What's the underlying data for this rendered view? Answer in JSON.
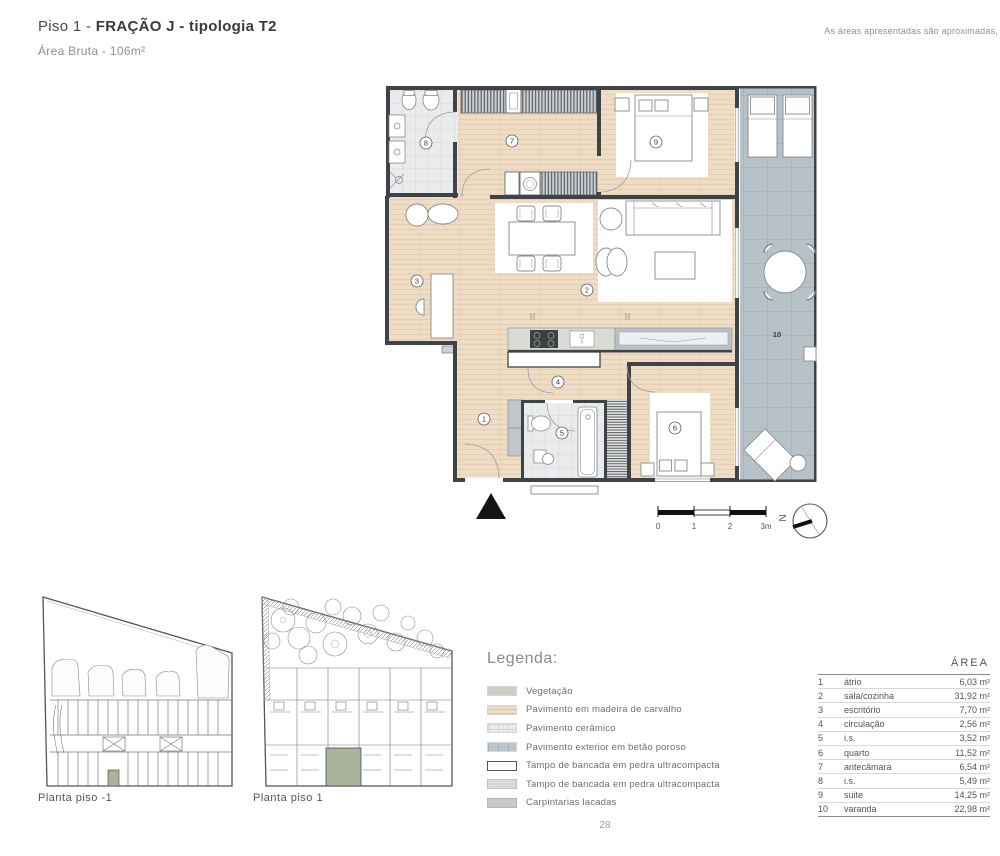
{
  "header": {
    "title_regular": "Piso 1 - ",
    "title_bold": "FRAÇÃO J - tipologia T2",
    "subtitle": "Área Bruta - 106m²",
    "note": "As áreas apresentadas são aproximadas,"
  },
  "plan": {
    "room_labels": [
      "1",
      "2",
      "3",
      "4",
      "5",
      "6",
      "7",
      "8",
      "9",
      "10"
    ],
    "north_label": "N",
    "scale_labels": [
      "0",
      "1",
      "2",
      "3m"
    ]
  },
  "site_plans": {
    "left_caption": "Planta piso -1",
    "right_caption": "Planta piso 1"
  },
  "legend": {
    "title": "Legenda:",
    "items": [
      {
        "label": "Vegetação"
      },
      {
        "label": "Pavimento em madeira de carvalho"
      },
      {
        "label": "Pavimento cerâmico"
      },
      {
        "label": "Pavimento exterior em betão poroso"
      },
      {
        "label": "Tampo de bancada em pedra ultracompacta"
      },
      {
        "label": "Tampo de bancada em pedra ultracompacta"
      },
      {
        "label": "Carpintarias lacadas"
      }
    ]
  },
  "area_table": {
    "header": "ÁREA",
    "rows": [
      {
        "num": "1",
        "name": "átrio",
        "area": "6,03 m²"
      },
      {
        "num": "2",
        "name": "sala/cozinha",
        "area": "31,92 m²"
      },
      {
        "num": "3",
        "name": "escritório",
        "area": "7,70 m²"
      },
      {
        "num": "4",
        "name": "circulação",
        "area": "2,56 m²"
      },
      {
        "num": "5",
        "name": "i.s.",
        "area": "3,52 m²"
      },
      {
        "num": "6",
        "name": "quarto",
        "area": "11,52 m²"
      },
      {
        "num": "7",
        "name": "antecâmara",
        "area": "6,54 m²"
      },
      {
        "num": "8",
        "name": "i.s.",
        "area": "5,49 m²"
      },
      {
        "num": "9",
        "name": "suite",
        "area": "14,25 m²"
      },
      {
        "num": "10",
        "name": "varanda",
        "area": "22,98 m²"
      }
    ]
  },
  "page": {
    "number": "28"
  },
  "colors": {
    "wood_floor": "#eedcc5",
    "ceramic_floor": "#e9ebec",
    "exterior_concrete": "#b7c1c8",
    "vegetation_swatch": "#c9cfc5",
    "unit_highlight": "#a9b399",
    "wall": "#3f4246",
    "countertop_gray": "#d8dbd7",
    "carpentry_gray": "#c5c9cc"
  }
}
